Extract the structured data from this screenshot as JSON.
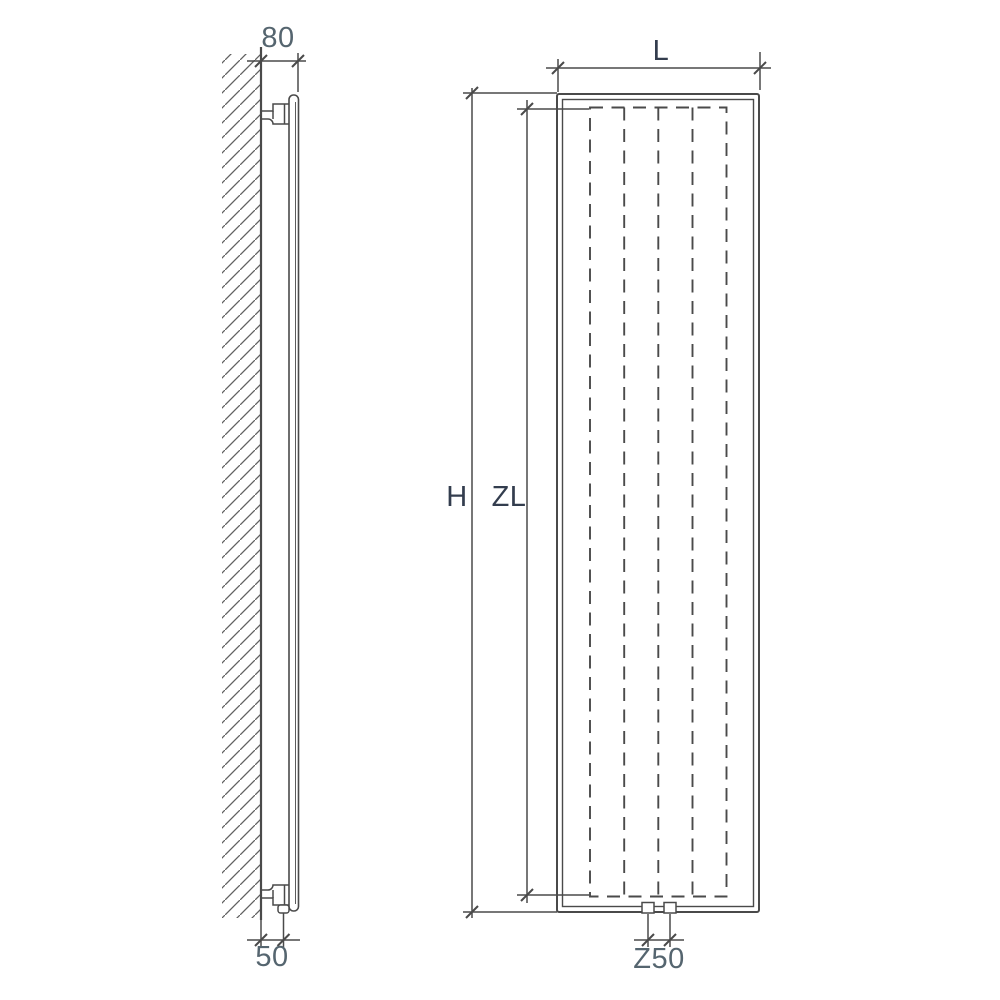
{
  "drawing_labels": {
    "side_view": {
      "wall_to_front_depth": "80",
      "wall_to_pipe_offset": "50"
    },
    "front_view": {
      "width": "L",
      "overall_height": "H",
      "element_height": "ZL",
      "connection_spacing": "Z50"
    }
  },
  "colors": {
    "background": "#ffffff",
    "line": "#4a4a4a",
    "hatch_line": "#606060",
    "label_blue_gray": "#55656f",
    "label_dark": "#333d4e"
  }
}
